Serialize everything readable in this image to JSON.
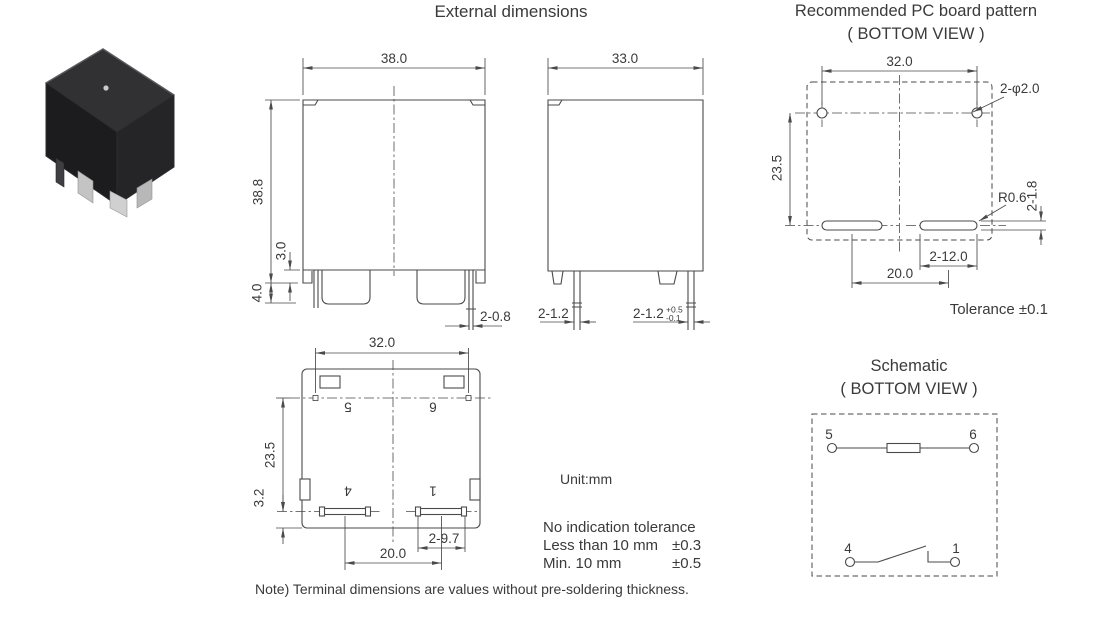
{
  "colors": {
    "background": "#ffffff",
    "line": "#4a4a4a",
    "text": "#3a3a3a",
    "relay_body": "#1c1c1e"
  },
  "titles": {
    "external": "External dimensions",
    "pcb": "Recommended PC board pattern",
    "pcb_sub": "( BOTTOM VIEW )",
    "schematic": "Schematic",
    "schematic_sub": "( BOTTOM VIEW )"
  },
  "front_view": {
    "width": "38.0",
    "height": "38.8",
    "standoff": "3.0",
    "terminal_height": "4.0",
    "pin_width": "2-0.8"
  },
  "side_view": {
    "width": "33.0",
    "pin_left": "2-1.2",
    "pin_right": "2-1.2",
    "pin_right_tol_upper": "+0.5",
    "pin_right_tol_lower": "-0.1"
  },
  "bottom_view": {
    "pin_span": "32.0",
    "height": "23.5",
    "terminal_offset": "3.2",
    "slot_width": "2-9.7",
    "pitch": "20.0",
    "pin5": "5",
    "pin6": "6",
    "pin4": "4",
    "pin1": "1"
  },
  "pcb_pattern": {
    "width": "32.0",
    "height": "23.5",
    "holes": "2-φ2.0",
    "corner_radius": "R0.6",
    "slot_height": "2-1.8",
    "slot_width": "2-12.0",
    "pitch": "20.0",
    "tolerance": "Tolerance ±0.1"
  },
  "schematic": {
    "pin5": "5",
    "pin6": "6",
    "pin4": "4",
    "pin1": "1"
  },
  "notes": {
    "unit": "Unit:mm",
    "tolerance_title": "No indication tolerance",
    "tolerance_row1_label": "Less than 10 mm",
    "tolerance_row1_value": "±0.3",
    "tolerance_row2_label": "Min. 10 mm",
    "tolerance_row2_value": "±0.5",
    "footnote": "Note) Terminal dimensions are values without pre-soldering thickness."
  }
}
